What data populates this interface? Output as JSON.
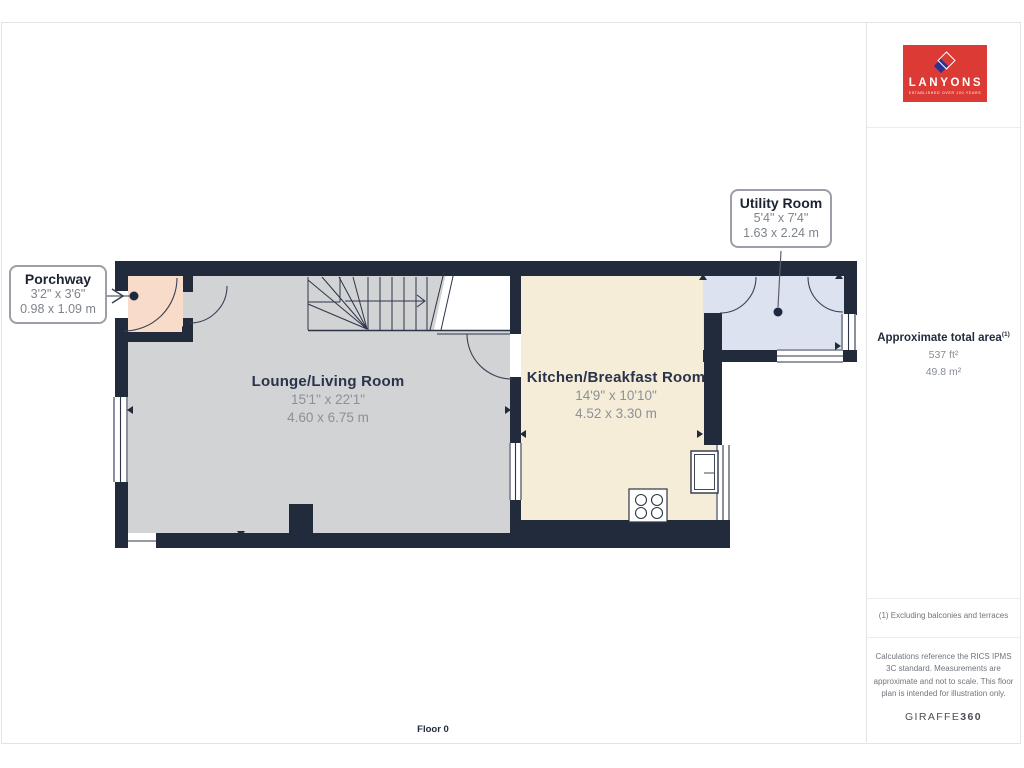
{
  "branding": {
    "logo_text": "LANYONS",
    "logo_tagline": "ESTABLISHED OVER 100 YEARS",
    "provider": "GIRAFFE",
    "provider_suffix": "360"
  },
  "sidebar": {
    "area_title": "Approximate total area",
    "area_title_sup": "(1)",
    "area_ft": "537 ft²",
    "area_m": "49.8 m²",
    "note": "(1) Excluding balconies and terraces",
    "disclaimer": "Calculations reference the RICS IPMS 3C standard. Measurements are approximate and not to scale. This floor plan is intended for illustration only."
  },
  "floor_label": "Floor 0",
  "rooms": [
    {
      "name": "Lounge/Living Room",
      "imperial": "15'1\" x 22'1\"",
      "metric": "4.60 x 6.75 m"
    },
    {
      "name": "Kitchen/Breakfast Room",
      "imperial": "14'9\" x 10'10\"",
      "metric": "4.52 x 3.30 m"
    }
  ],
  "callouts": [
    {
      "name": "Porchway",
      "imperial": "3'2\" x 3'6\"",
      "metric": "0.98 x 1.09 m"
    },
    {
      "name": "Utility Room",
      "imperial": "5'4\" x 7'4\"",
      "metric": "1.63 x 2.24 m"
    }
  ],
  "colors": {
    "wall": "#212b3c",
    "lounge_fill": "#d2d3d5",
    "kitchen_fill": "#f5edd8",
    "porch_fill": "#f8dcc9",
    "utility_fill": "#dde2f0",
    "logo_red": "#dc3a34",
    "logo_blue": "#2f3093",
    "title_text": "#232c3f",
    "dim_text": "#8b9099"
  }
}
